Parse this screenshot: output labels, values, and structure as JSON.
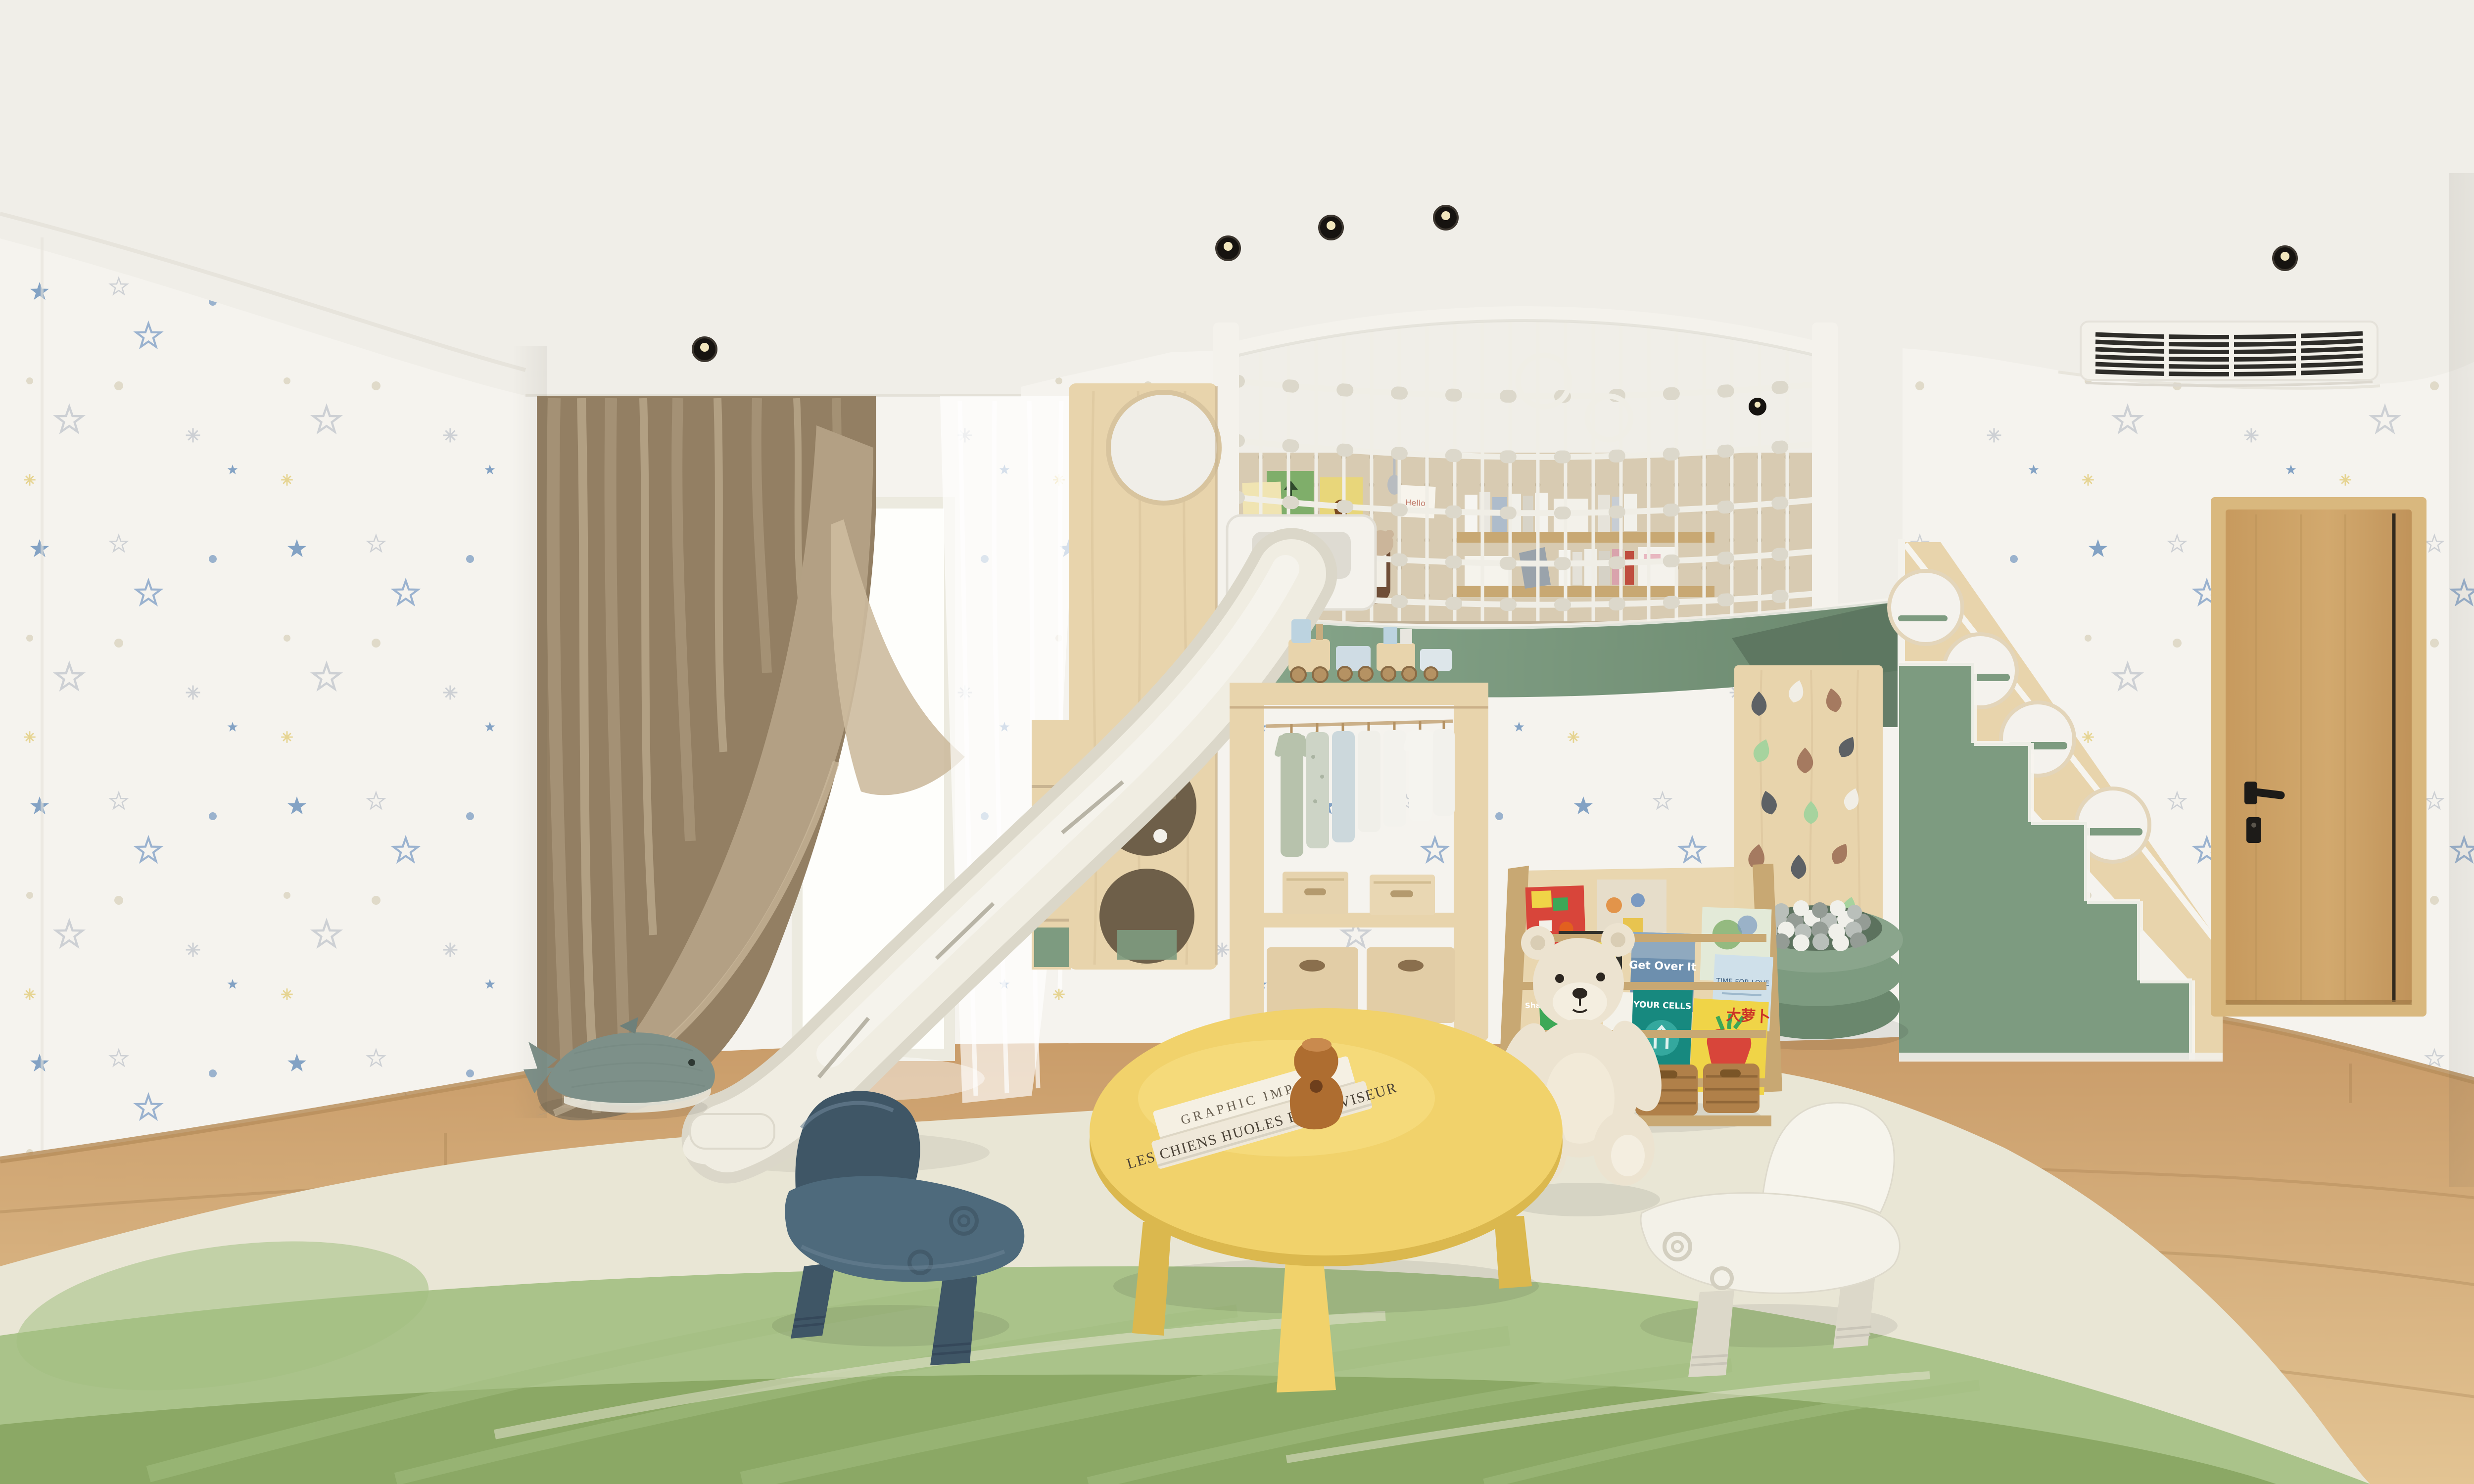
{
  "scene": {
    "description": "360-degree panorama of a children's playroom with loft bed, rope-net railing, white slide, climbing wall, ball pit, green staircase with porthole balustrade, wardrobe rack, sling bookshelf, teddy bear, yellow play table and star wallpaper"
  },
  "palette": {
    "wall": "#f5f3ee",
    "ceiling": "#f0eee8",
    "cove": "#e3e0d7",
    "star_blue": "#6f94bd",
    "star_outline": "#8aa6ca",
    "star_gray": "#c6cacf",
    "dot_beige": "#dcd6c2",
    "sparkle_yellow": "#e3cf82",
    "floor_hi": "#c89a67",
    "floor_lo": "#e3c493",
    "plank": "#9d7848",
    "baseboard": "#b98f5d",
    "rug_cream": "#e9e6d5",
    "rug_green": "#a3bf82",
    "rug_green_deep": "#87a561",
    "curtain": "#b3a084",
    "curtain_dark": "#937f63",
    "curtain_light": "#cdbb9e",
    "sheer": "#ffffff",
    "net_white": "#f0eee6",
    "net_knot": "#dcd8cb",
    "frame_white": "#f4f2ec",
    "pegboard": "#d8cbb2",
    "peg_dot": "#c2b398",
    "wood_light": "#e8d4ac",
    "wood_mid": "#c8a873",
    "wood_dark": "#a98753",
    "green": "#7d9b80",
    "green_dark": "#6a876d",
    "green_deep": "#5d7660",
    "slide_body": "#f0ede2",
    "slide_edge": "#dbd7c9",
    "slide_seam": "#b8b4a6",
    "door_wood": "#c99f63",
    "door_frame": "#d9b87e",
    "door_groove": "#32291d",
    "handle_black": "#1d1b18",
    "vent_frame": "#f3f1ea",
    "vent_slat": "#2e2d29",
    "table_yellow": "#f1d26b",
    "table_yellow_dark": "#dbb84e",
    "sculpture_brown": "#ae6d30",
    "chair_blue": "#4e6a7c",
    "chair_blue_dark": "#3f5666",
    "chair_white": "#f3f1e8",
    "chair_white_dark": "#dcd8c9",
    "teddy": "#ece3d0",
    "teddy_shadow": "#d9cdb4",
    "whale": "#7d9089",
    "whale_belly": "#e8e6da",
    "ball_white": "#f0f0ea",
    "ball_gray": "#b9bfba",
    "ball_dark": "#949c95",
    "basket": "#b08049",
    "basket_dark": "#8a6134",
    "hold_gray": "#5d6165",
    "hold_brown": "#a57a60",
    "hold_white": "#f1eee6",
    "hold_mint": "#a6d39e",
    "cover_red": "#d8453a",
    "cover_blue": "#6d8fae",
    "cover_green": "#3da857",
    "cover_teal": "#17897f",
    "cover_yellow": "#f0d447",
    "cover_lightblue": "#cfe0ea",
    "light_black": "#161310"
  },
  "texts": {
    "book_stack_top_spine": "GRAPHIC IMPACT",
    "book_stack_bottom_spine": "LES CHIENS HUOLES RETROVISEUR",
    "poster_picasso": "PICASSO",
    "poster_hello": "Hello!",
    "book_get_over_it": "Get Over It",
    "book_shares": "Shares Super Simple",
    "book_cells": "YOUR CELLS",
    "book_radish": "大萝卜",
    "book_love": "TIME FOR LOVE"
  },
  "objects": {
    "loft": "loft bed with rope net railing",
    "slide": "white kids slide",
    "stairs": "green staircase with porthole balustrade",
    "door": "wooden room door",
    "vent": "air conditioning vent",
    "window": "bright window with curtains",
    "wardrobe": "kids wardrobe rack with hanging clothes",
    "bookshelf": "sling bookshelf with picture books",
    "teddy": "plush teddy bear",
    "climbing_wall": "toddler climbing wall",
    "ball_pit": "green ball pit with gray and white balls",
    "table": "yellow round play table",
    "chair_blue": "blue toddler chair",
    "chair_white": "white toddler chair",
    "whale": "knitted whale plush",
    "rug": "green and cream area rug"
  }
}
